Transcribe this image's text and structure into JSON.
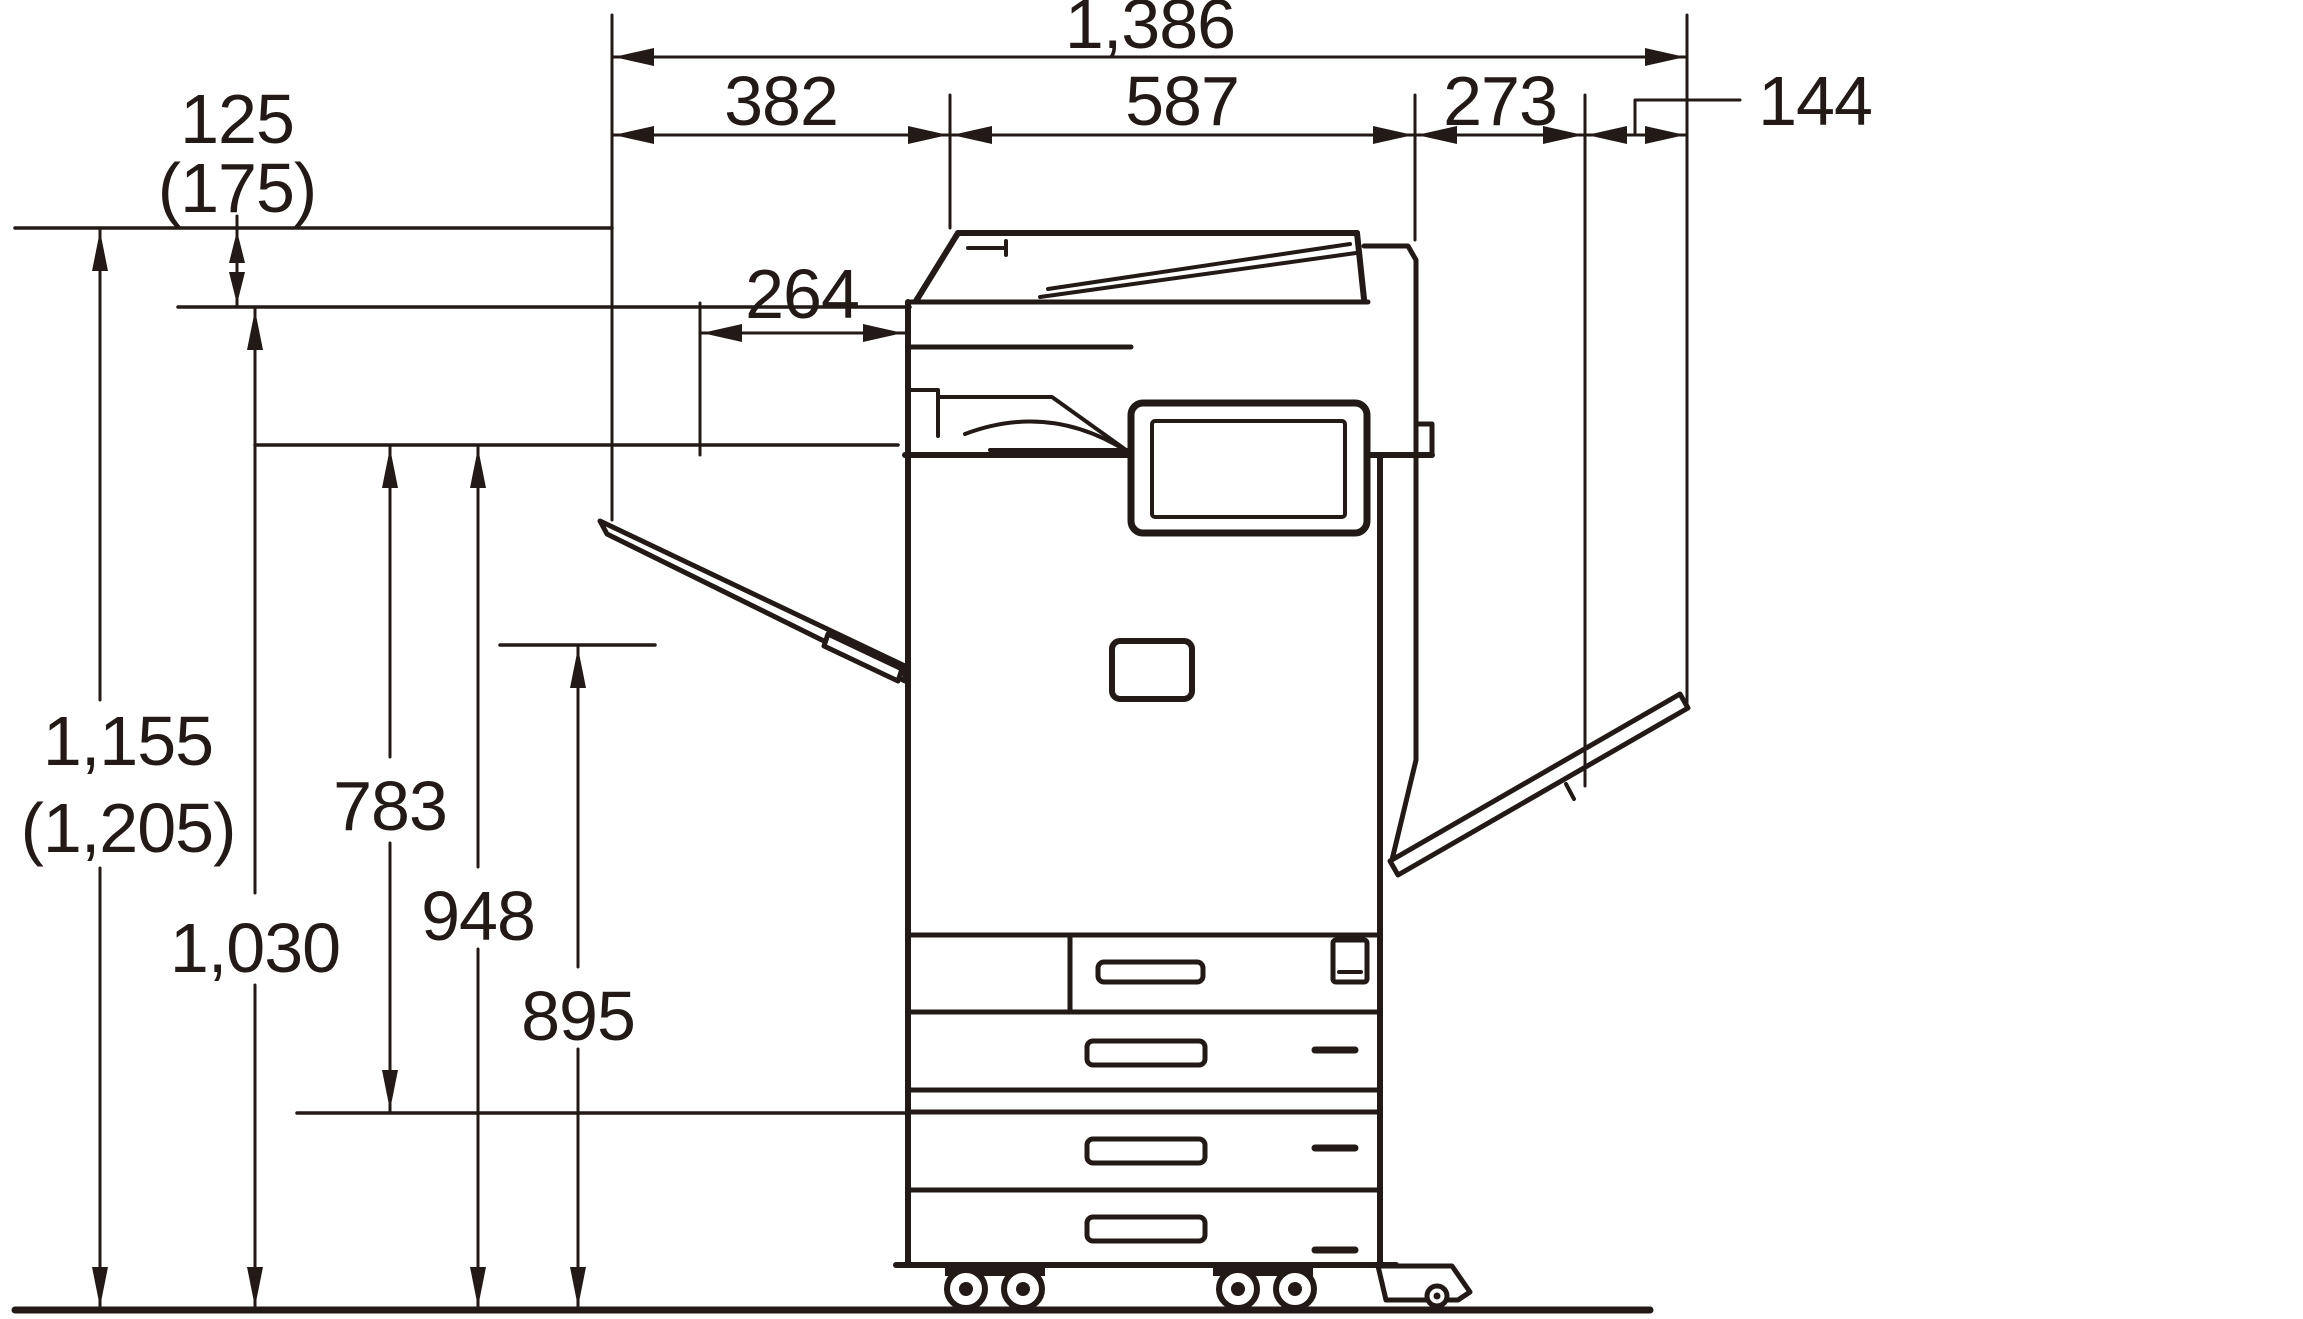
{
  "canvas": {
    "width": 2303,
    "height": 1319,
    "background": "#ffffff",
    "line_color": "#231916"
  },
  "dimensions": {
    "top": {
      "total": {
        "label": "1,386"
      },
      "segments": [
        {
          "id": "left-tray-extension",
          "label": "382"
        },
        {
          "id": "body-depth",
          "label": "587"
        },
        {
          "id": "right-tray-extension",
          "label": "273"
        },
        {
          "id": "right-tray-tip",
          "label": "144"
        }
      ],
      "left_tray_fold": {
        "label": "264"
      }
    },
    "left": {
      "top_offset": {
        "value": "125",
        "alt": "(175)"
      },
      "total_height": {
        "value": "1,155",
        "alt": "(1,205)"
      },
      "glass_height": {
        "label": "1,030"
      },
      "tray_span": {
        "label": "783"
      },
      "tray_top_height": {
        "label": "948"
      },
      "support_height": {
        "label": "895"
      }
    }
  }
}
